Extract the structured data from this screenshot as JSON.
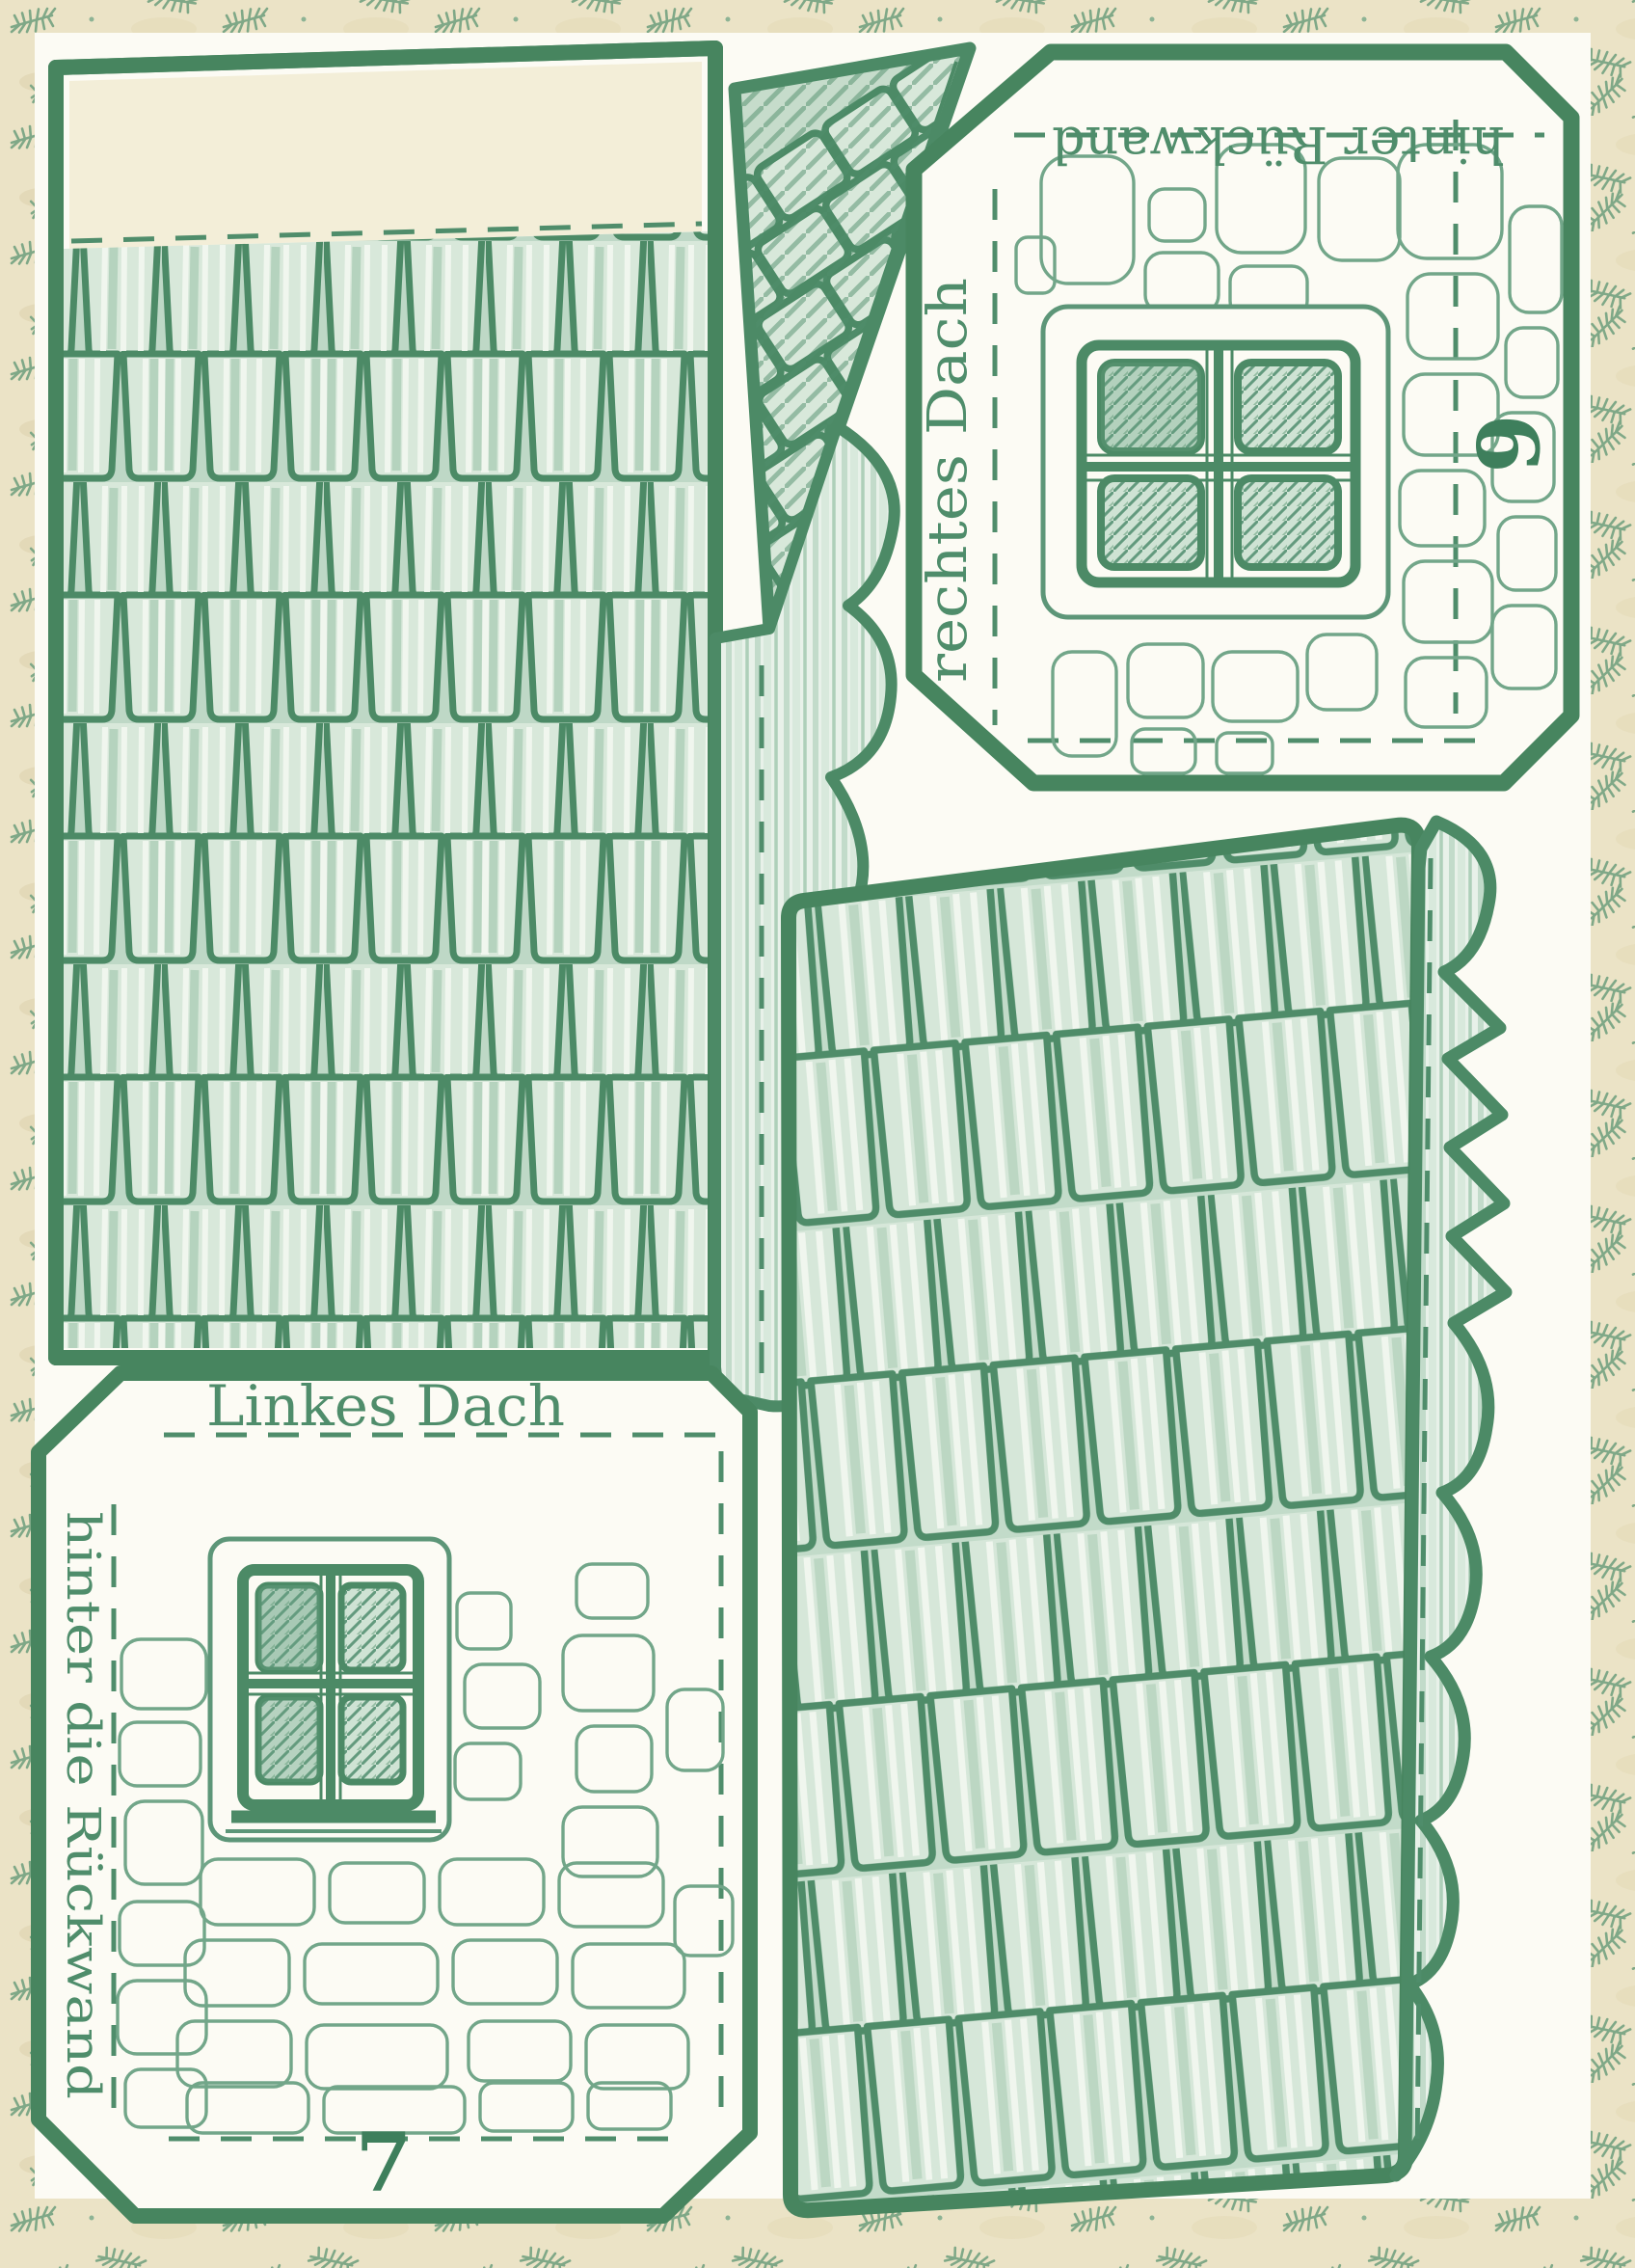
{
  "pieces": {
    "piece_6": {
      "top_edge": "hinter Rückwand",
      "left_edge": "rechtes Dach",
      "number": "6"
    },
    "piece_7": {
      "top_edge": "Linkes Dach",
      "left_edge": "hinter die Rückwand",
      "number": "7"
    }
  },
  "colors": {
    "ink_green": "#4c8a66",
    "border_green": "#47855f",
    "shingle_fill_light": "#d8e8da",
    "shingle_shade": "#a9cbb3",
    "stone_outline": "#72a689",
    "pane_green": "#cfe3d4",
    "paper_white": "#fcfbf4",
    "margin_cream": "#ebe3c6",
    "fir_sprig_green": "#7fa887",
    "glue_tab_cream": "#f3eed8"
  }
}
